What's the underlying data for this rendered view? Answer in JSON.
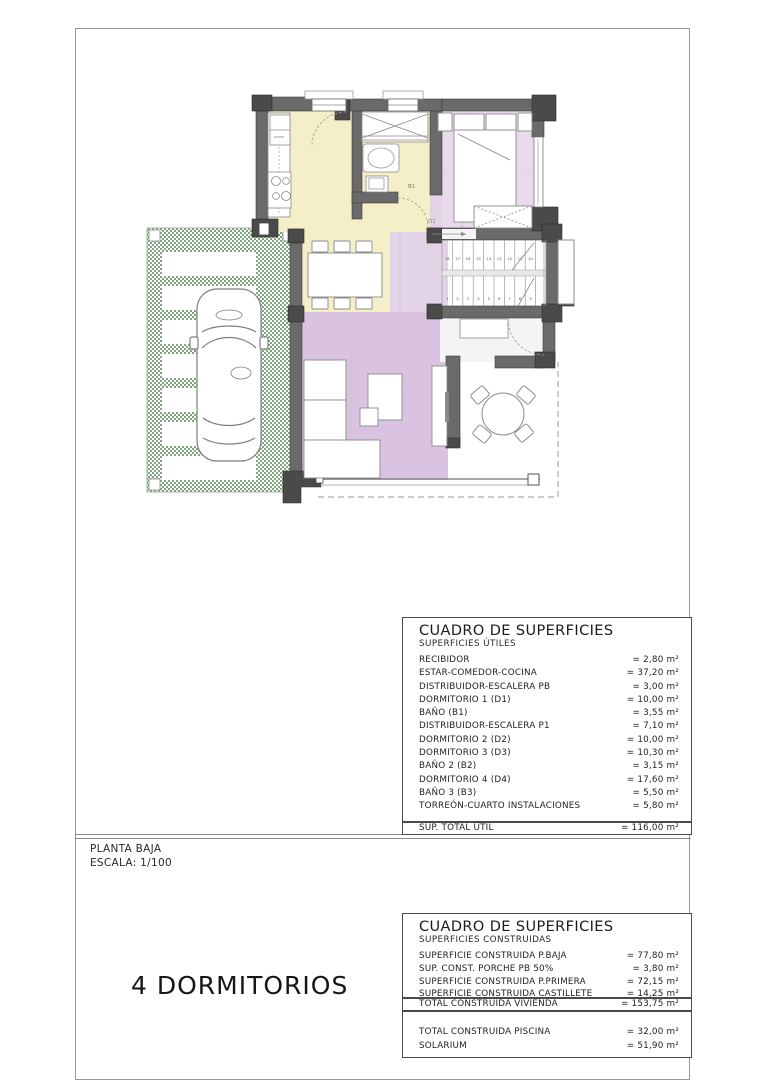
{
  "plan": {
    "labels": {
      "bath1": "B1",
      "dorm1": "D1"
    },
    "stairs": {
      "top_run": [
        "18",
        "17",
        "16",
        "15",
        "14",
        "13",
        "12",
        "11",
        "10"
      ],
      "bottom_run": [
        "1",
        "2",
        "3",
        "4",
        "5",
        "6",
        "7",
        "8",
        "9"
      ]
    },
    "colors": {
      "kitchen_yellow": "#f4eec9",
      "bedroom_purple": "#e8d9eb",
      "living_purple": "#d9c3e1",
      "distributor_purple": "#e3d3e7",
      "hall_white": "#f6f3f7",
      "wall": "#6a6a6a",
      "wall_dark": "#4a4a4a",
      "grass_green": "#7fa57f"
    }
  },
  "title_block": {
    "floor": "PLANTA BAJA",
    "scale": "ESCALA: 1/100",
    "headline": "4 DORMITORIOS"
  },
  "surface_table_util": {
    "title": "CUADRO DE SUPERFICIES",
    "subtitle": "SUPERFICIES ÚTILES",
    "rows": [
      {
        "label": "RECIBIDOR",
        "value": "= 2,80 m²"
      },
      {
        "label": "ESTAR-COMEDOR-COCINA",
        "value": "= 37,20 m²"
      },
      {
        "label": "DISTRIBUIDOR-ESCALERA PB",
        "value": "= 3,00 m²"
      },
      {
        "label": "DORMITORIO 1 (D1)",
        "value": "= 10,00 m²"
      },
      {
        "label": "BAÑO (B1)",
        "value": "= 3,55 m²"
      },
      {
        "label": "DISTRIBUIDOR-ESCALERA P1",
        "value": "= 7,10 m²"
      },
      {
        "label": "DORMITORIO 2 (D2)",
        "value": "= 10,00 m²"
      },
      {
        "label": "DORMITORIO 3 (D3)",
        "value": "= 10,30 m²"
      },
      {
        "label": "BAÑO 2 (B2)",
        "value": "= 3,15 m²"
      },
      {
        "label": "DORMITORIO 4 (D4)",
        "value": "= 17,60 m²"
      },
      {
        "label": "BAÑO 3 (B3)",
        "value": "= 5,50 m²"
      },
      {
        "label": "TORREÓN-CUARTO INSTALACIONES",
        "value": "= 5,80 m²"
      }
    ],
    "total": {
      "label": "SUP. TOTAL ÚTIL",
      "value": "= 116,00 m²"
    }
  },
  "surface_table_const": {
    "title": "CUADRO DE SUPERFICIES",
    "subtitle": "SUPERFICIES CONSTRUIDAS",
    "rows": [
      {
        "label": "SUPERFICIE CONSTRUIDA P.BAJA",
        "value": "= 77,80 m²"
      },
      {
        "label": "SUP. CONST. PORCHE PB 50%",
        "value": "= 3,80 m²"
      },
      {
        "label": "SUPERFICIE CONSTRUIDA P.PRIMERA",
        "value": "= 72,15 m²"
      },
      {
        "label": "SUPERFICIE CONSTRUIDA CASTILLETE",
        "value": "= 14,25 m²"
      }
    ],
    "total": {
      "label": "TOTAL CONSTRUIDA VIVIENDA",
      "value": "= 153,75 m²"
    },
    "extra_rows": [
      {
        "label": "TOTAL CONSTRUIDA PISCINA",
        "value": "= 32,00 m²"
      },
      {
        "label": "SOLARIUM",
        "value": "= 51,90 m²"
      }
    ]
  }
}
